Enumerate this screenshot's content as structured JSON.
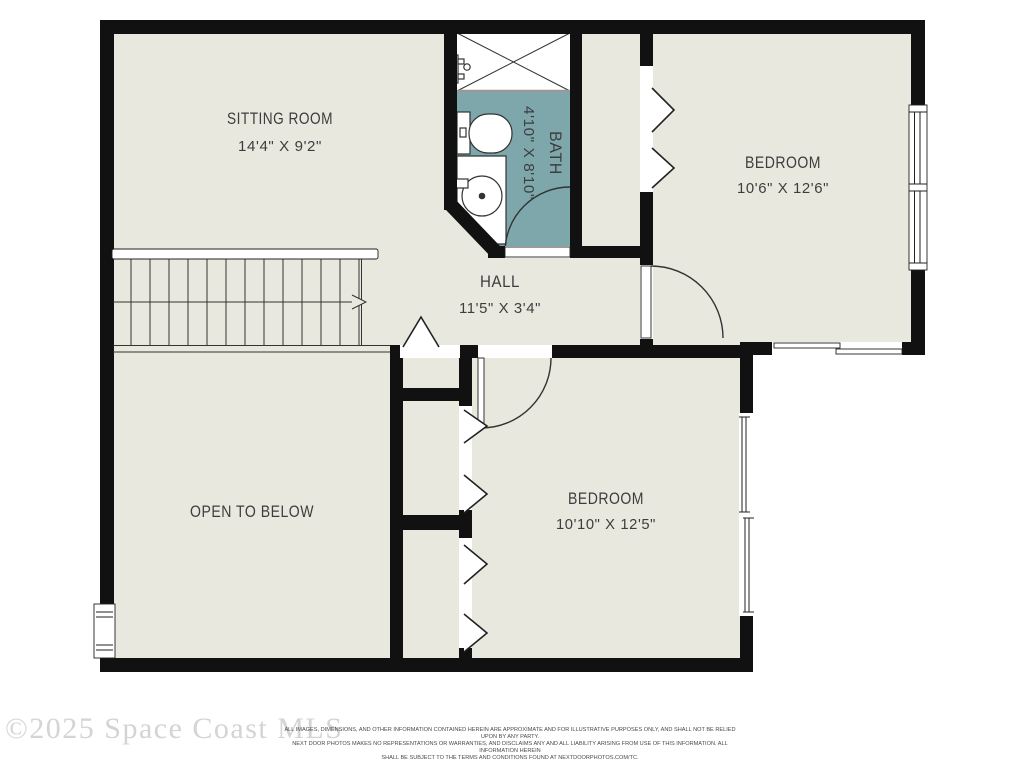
{
  "plan": {
    "rooms": {
      "sitting_room": {
        "name": "SITTING ROOM",
        "dims": "14'4\" X 9'2\""
      },
      "bath": {
        "name": "BATH",
        "dims": "4'10\" X 8'10\""
      },
      "bedroom_top": {
        "name": "BEDROOM",
        "dims": "10'6\" X 12'6\""
      },
      "hall": {
        "name": "HALL",
        "dims": "11'5\" X 3'4\""
      },
      "open_to_below": {
        "name": "OPEN TO BELOW"
      },
      "bedroom_bottom": {
        "name": "BEDROOM",
        "dims": "10'10\" X 12'5\""
      }
    },
    "colors": {
      "floor": "#e9e8df",
      "bath_floor": "#7ea7ac",
      "wall": "#111111",
      "line": "#333333",
      "label": "#3d3d3d"
    },
    "icons": {
      "shower": "shower-tub with X marker",
      "toilet": "toilet top view",
      "sink": "round vanity sink",
      "door": "quarter-circle swing arc",
      "bifold_closet": "chevron zigzag",
      "sliding_door": "offset double panel",
      "window": "double-line window",
      "stairs": "treads with up arrow"
    }
  },
  "footer": {
    "watermark": "©2025 Space Coast MLS",
    "disclaimer_lines": [
      "ALL IMAGES, DIMENSIONS, AND OTHER INFORMATION CONTAINED HEREIN ARE APPROXIMATE AND FOR ILLUSTRATIVE PURPOSES ONLY, AND SHALL NOT BE RELIED UPON BY ANY PARTY.",
      "NEXT DOOR PHOTOS MAKES NO REPRESENTATIONS OR WARRANTIES, AND DISCLAIMS ANY AND ALL LIABILITY ARISING FROM USE OF THIS INFORMATION. ALL INFORMATION HEREIN",
      "SHALL BE SUBJECT TO THE TERMS AND CONDITIONS FOUND AT NEXTDOORPHOTOS.COM/TC."
    ]
  }
}
